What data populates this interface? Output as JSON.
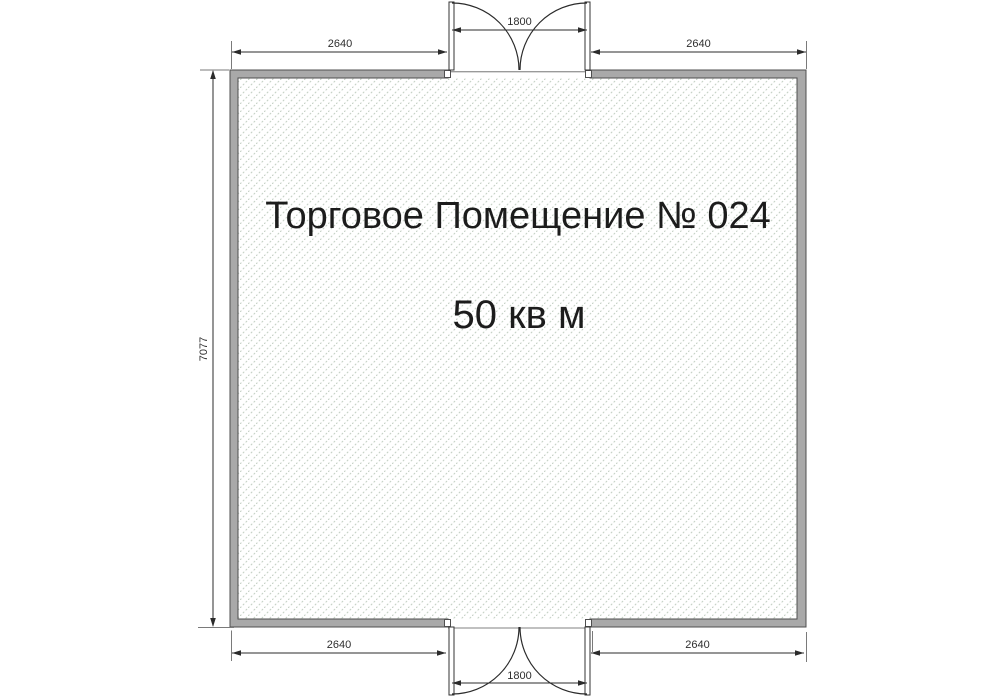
{
  "room": {
    "title": "Торговое Помещение № 024",
    "area": "50 кв м"
  },
  "dimensions": {
    "top_left_width": "2640",
    "top_door_width": "1800",
    "top_right_width": "2640",
    "left_height": "7077",
    "bottom_left_width": "2640",
    "bottom_door_width": "1800",
    "bottom_right_width": "2640"
  },
  "colors": {
    "wall_fill": "#a9a9a9",
    "wall_outline": "#4f4f4f",
    "hatch_line": "#c3cfc3",
    "dimension_line": "#2b2b2b",
    "text": "#1c1c1c"
  }
}
